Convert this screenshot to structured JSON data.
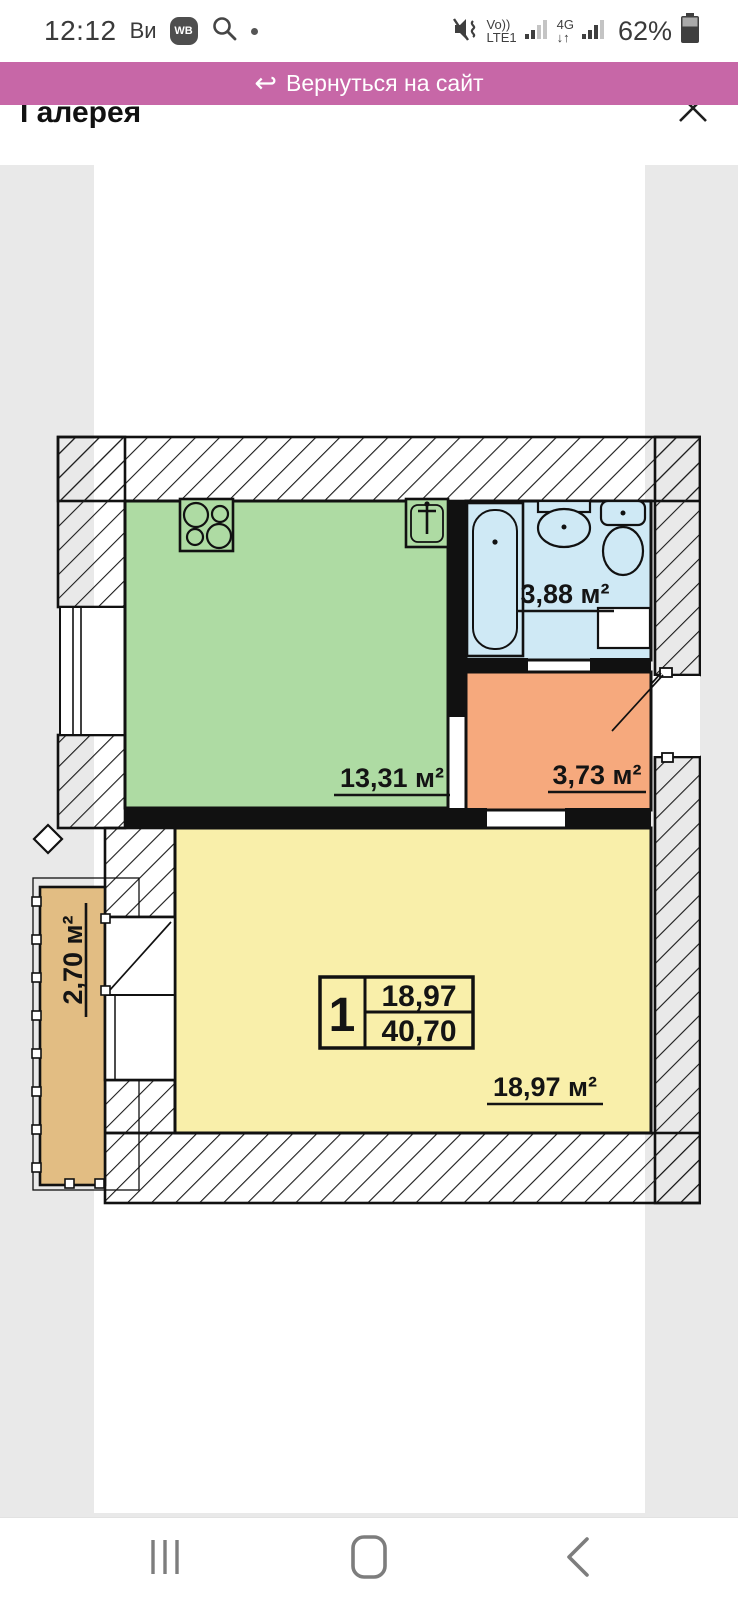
{
  "status_bar": {
    "time": "12:12",
    "notification_text": "Ви",
    "wb_badge_label": "WB",
    "volte_top": "Vo))",
    "volte_bottom": "LTE1",
    "network_type": "4G",
    "network_arrows": "↓↑",
    "battery_percent": "62%"
  },
  "banner": {
    "return_icon": "↩",
    "label": "Вернуться на сайт"
  },
  "gallery": {
    "title": "Галерея"
  },
  "floor_plan": {
    "stamp": {
      "rooms_count": "1",
      "living_area": "18,97",
      "total_area": "40,70"
    },
    "kitchen_area": "13,31 м²",
    "bathroom_area": "3,88 м²",
    "hallway_area": "3,73 м²",
    "living_room_area": "18,97 м²",
    "balcony_area": "2,70 м²"
  },
  "colors": {
    "banner_pink": "#c767a7",
    "kitchen_green": "#aedba3",
    "bathroom_blue": "#cfe9f5",
    "hallway_orange": "#f6a97d",
    "living_yellow": "#f9efaa",
    "balcony_tan": "#e2bd83",
    "page_gray": "#e9e9e9"
  }
}
